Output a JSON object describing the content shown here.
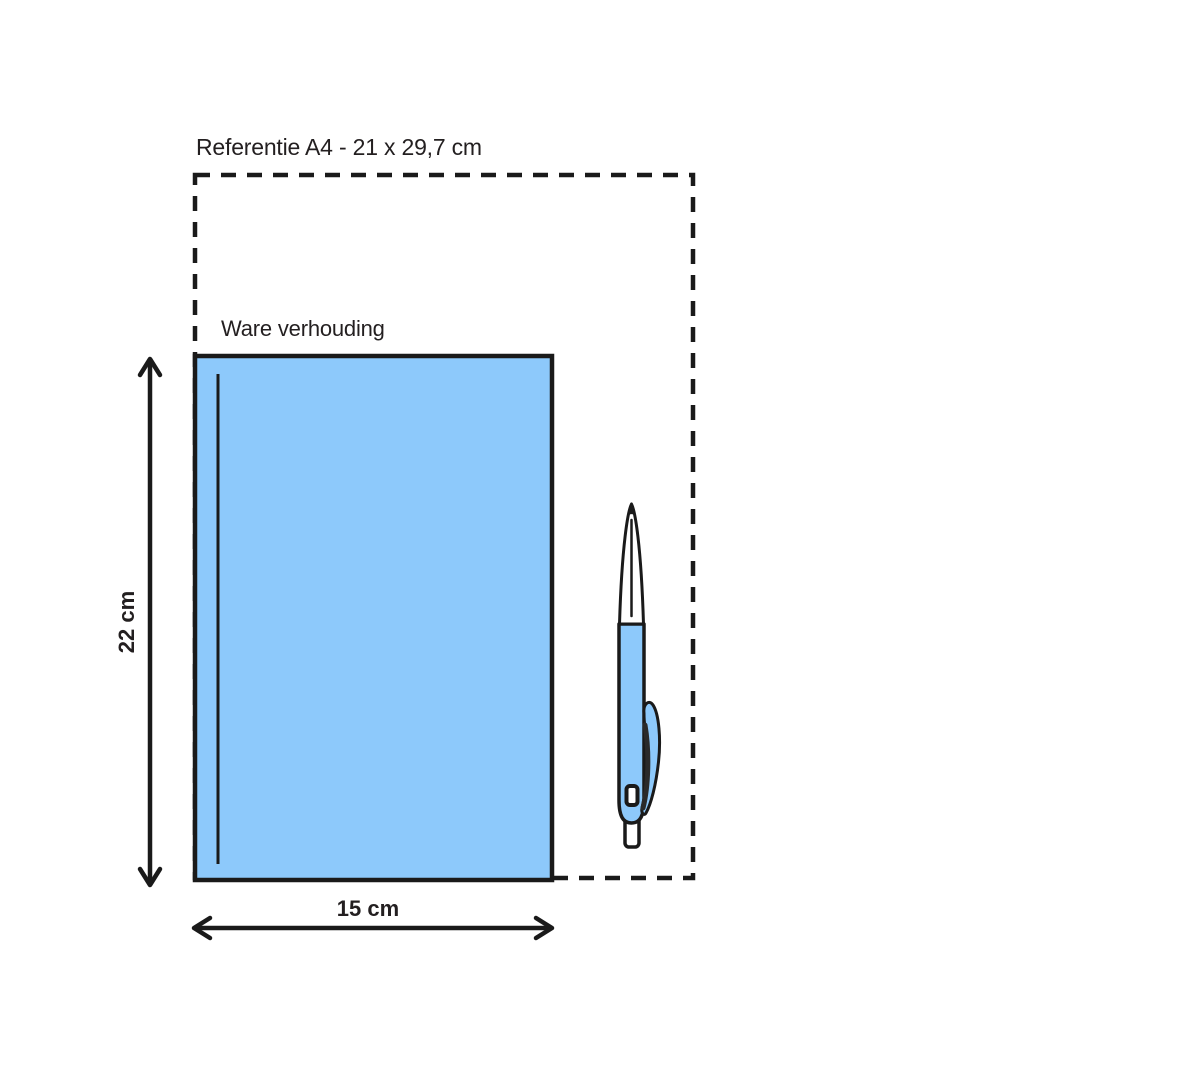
{
  "diagram": {
    "title": "Referentie A4 - 21 x 29,7 cm",
    "scale_note": "Ware verhouding",
    "height_dimension": "22 cm",
    "width_dimension": "15 cm",
    "reference_size_cm": {
      "width": "21",
      "height": "29,7"
    },
    "object_size_cm": {
      "width": "15",
      "height": "22"
    }
  },
  "colors": {
    "object_fill": "#8DC9FB",
    "outline": "#1A1A1A",
    "background": "#FFFFFF"
  },
  "icons": {
    "book": "book-cover-rectangle",
    "pen": "ballpoint-pen-illustration"
  }
}
